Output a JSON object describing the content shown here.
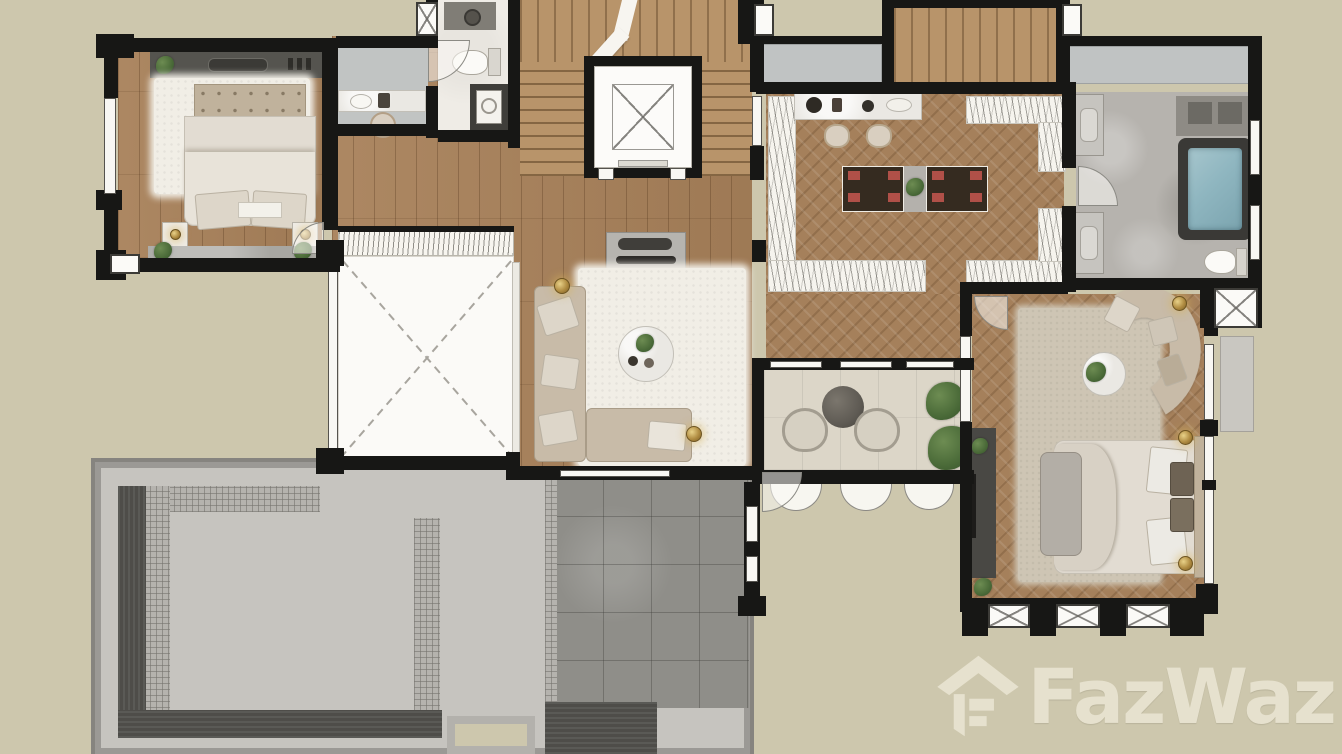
{
  "watermark": {
    "brand": "FazWaz",
    "icon": "fazwaz-house-icon"
  },
  "palette": {
    "bg": "#cdc7ad",
    "wall": "#171715",
    "wood": "#a8815a",
    "woodlight": "#b8946a",
    "herring": "#a5805b",
    "whitefloor": "#efece6",
    "grayfloor": "#b6b3ae",
    "stonetile": "#8f8e89",
    "roofgray": "#c6c4bf",
    "roofrim": "#9b9995",
    "roofdark": "#4e4d49",
    "coping": "#b5b3ae",
    "balcfloor": "#dcd6c8",
    "rugwhite": "#f1eee6",
    "rugbeige": "#cec5b4",
    "sofa": "#c8bba8",
    "bedwhite": "#e2dcd2",
    "headboard": "#c0b29c",
    "tabledark": "#352b20",
    "matred": "#b05048",
    "water": "#8fb6c0",
    "tubframe": "#3a3936",
    "gold": "#b08c42",
    "plantgreen": "#51713f",
    "watermark": "#e9e4d1"
  }
}
